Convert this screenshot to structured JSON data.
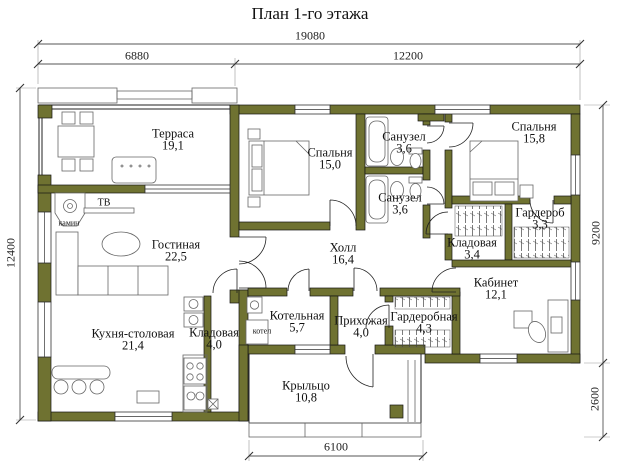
{
  "title": "План 1-го этажа",
  "dimensions": {
    "top_total": "19080",
    "top_left": "6880",
    "top_right": "12200",
    "left": "12400",
    "right_upper": "9200",
    "right_lower": "2600",
    "bottom": "6100"
  },
  "rooms": [
    {
      "name": "Терраса",
      "area": "19,1"
    },
    {
      "name": "Гостиная",
      "area": "22,5"
    },
    {
      "name": "Кухня-столовая",
      "area": "21,4"
    },
    {
      "name": "Кладовая",
      "area": "4,0"
    },
    {
      "name": "Котельная",
      "area": "5,7"
    },
    {
      "name": "Прихожая",
      "area": "4,0"
    },
    {
      "name": "Гардеробная",
      "area": "4,3"
    },
    {
      "name": "Спальня",
      "area": "15,0"
    },
    {
      "name": "Санузел",
      "area": "3,6"
    },
    {
      "name": "Санузел",
      "area": "3,6"
    },
    {
      "name": "Холл",
      "area": "16,4"
    },
    {
      "name": "Спальня",
      "area": "15,8"
    },
    {
      "name": "Гардероб",
      "area": "3,3"
    },
    {
      "name": "Кладовая",
      "area": "3,4"
    },
    {
      "name": "Кабинет",
      "area": "12,1"
    },
    {
      "name": "Крыльцо",
      "area": "10,8"
    }
  ],
  "annotations": {
    "fireplace": "камин",
    "tv": "ТВ",
    "boiler": "котел"
  },
  "colors": {
    "wall": "#6f7231",
    "line": "#222222",
    "background": "#ffffff"
  }
}
